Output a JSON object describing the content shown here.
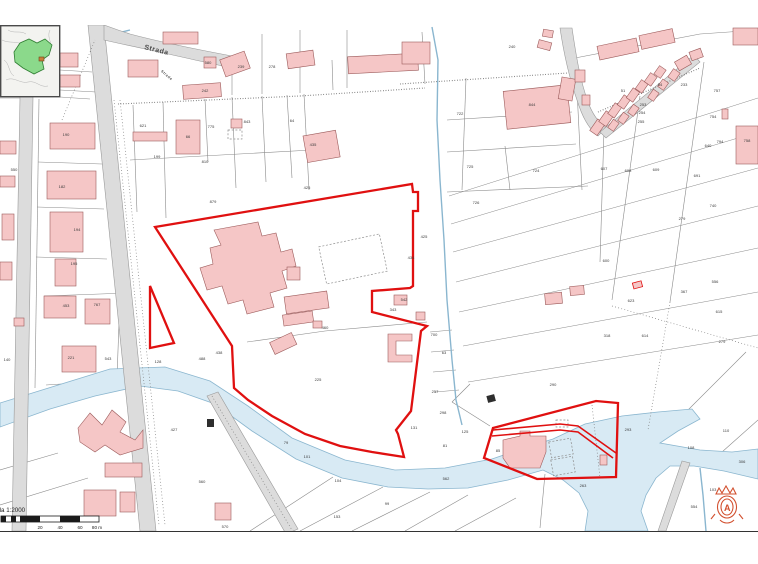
{
  "colors": {
    "boundary_red": "#e01010",
    "building_fill": "#f5c6c6",
    "building_stroke": "#9c5b5b",
    "water_fill": "#d8eaf4",
    "water_stroke": "#8ab6cf",
    "road_fill": "#dcdcdc",
    "road_stroke": "#9a9a9a",
    "parcel_line": "#8a8a8a",
    "label_color": "#3a3a3a",
    "inset_green": "#8bd98b",
    "stamp_color": "#d2502f"
  },
  "scale": {
    "text": "Scala 1:2000",
    "ticks": [
      {
        "t": "20",
        "x": 40
      },
      {
        "t": "40",
        "x": 60
      },
      {
        "t": "60",
        "x": 80
      },
      {
        "t": "80 m",
        "x": 97
      }
    ]
  },
  "road_labels": [
    {
      "t": "Strada",
      "x": 156,
      "y": 52,
      "r": 14,
      "s": 7
    },
    {
      "t": "Strada",
      "x": 166,
      "y": 76,
      "r": 40,
      "s": 3.5
    }
  ],
  "stamp": {
    "letter": "A"
  },
  "parcel_labels": [
    {
      "t": "879",
      "x": 213,
      "y": 203
    },
    {
      "t": "425",
      "x": 307,
      "y": 189
    },
    {
      "t": "425",
      "x": 424,
      "y": 238
    },
    {
      "t": "434",
      "x": 411,
      "y": 259
    },
    {
      "t": "542",
      "x": 404,
      "y": 301
    },
    {
      "t": "343",
      "x": 393,
      "y": 311
    },
    {
      "t": "700",
      "x": 434,
      "y": 336
    },
    {
      "t": "225",
      "x": 318,
      "y": 381
    },
    {
      "t": "460",
      "x": 325,
      "y": 329
    },
    {
      "t": "131",
      "x": 414,
      "y": 429
    },
    {
      "t": "257",
      "x": 435,
      "y": 393
    },
    {
      "t": "298",
      "x": 443,
      "y": 414
    },
    {
      "t": "63",
      "x": 444,
      "y": 354
    },
    {
      "t": "81",
      "x": 445,
      "y": 447
    },
    {
      "t": "79",
      "x": 286,
      "y": 444
    },
    {
      "t": "101",
      "x": 307,
      "y": 458
    },
    {
      "t": "104",
      "x": 338,
      "y": 482
    },
    {
      "t": "99",
      "x": 387,
      "y": 505
    },
    {
      "t": "153",
      "x": 337,
      "y": 518
    },
    {
      "t": "570",
      "x": 225,
      "y": 528
    },
    {
      "t": "560",
      "x": 202,
      "y": 483
    },
    {
      "t": "427",
      "x": 174,
      "y": 431
    },
    {
      "t": "128",
      "x": 158,
      "y": 363
    },
    {
      "t": "438",
      "x": 219,
      "y": 354
    },
    {
      "t": "488",
      "x": 202,
      "y": 360
    },
    {
      "t": "453",
      "x": 66,
      "y": 307
    },
    {
      "t": "767",
      "x": 97,
      "y": 306
    },
    {
      "t": "221",
      "x": 71,
      "y": 359
    },
    {
      "t": "543",
      "x": 108,
      "y": 360
    },
    {
      "t": "140",
      "x": 7,
      "y": 361
    },
    {
      "t": "190",
      "x": 66,
      "y": 136
    },
    {
      "t": "182",
      "x": 62,
      "y": 188
    },
    {
      "t": "194",
      "x": 77,
      "y": 231
    },
    {
      "t": "195",
      "x": 74,
      "y": 265
    },
    {
      "t": "550",
      "x": 14,
      "y": 171
    },
    {
      "t": "621",
      "x": 143,
      "y": 127
    },
    {
      "t": "199",
      "x": 157,
      "y": 158
    },
    {
      "t": "66",
      "x": 188,
      "y": 138
    },
    {
      "t": "775",
      "x": 211,
      "y": 128
    },
    {
      "t": "843",
      "x": 247,
      "y": 123
    },
    {
      "t": "64",
      "x": 292,
      "y": 122
    },
    {
      "t": "435",
      "x": 313,
      "y": 146
    },
    {
      "t": "242",
      "x": 205,
      "y": 92
    },
    {
      "t": "580",
      "x": 208,
      "y": 64
    },
    {
      "t": "239",
      "x": 241,
      "y": 68
    },
    {
      "t": "278",
      "x": 272,
      "y": 68
    },
    {
      "t": "810",
      "x": 205,
      "y": 163
    },
    {
      "t": "844",
      "x": 532,
      "y": 106
    },
    {
      "t": "240",
      "x": 512,
      "y": 48
    },
    {
      "t": "722",
      "x": 460,
      "y": 115
    },
    {
      "t": "724",
      "x": 536,
      "y": 172
    },
    {
      "t": "725",
      "x": 470,
      "y": 168
    },
    {
      "t": "726",
      "x": 476,
      "y": 204
    },
    {
      "t": "757",
      "x": 717,
      "y": 92
    },
    {
      "t": "754",
      "x": 713,
      "y": 118
    },
    {
      "t": "794",
      "x": 720,
      "y": 143
    },
    {
      "t": "640",
      "x": 708,
      "y": 147
    },
    {
      "t": "691",
      "x": 697,
      "y": 177
    },
    {
      "t": "740",
      "x": 713,
      "y": 207
    },
    {
      "t": "279",
      "x": 682,
      "y": 220
    },
    {
      "t": "600",
      "x": 606,
      "y": 262
    },
    {
      "t": "556",
      "x": 715,
      "y": 283
    },
    {
      "t": "367",
      "x": 684,
      "y": 293
    },
    {
      "t": "623",
      "x": 631,
      "y": 302
    },
    {
      "t": "615",
      "x": 719,
      "y": 313
    },
    {
      "t": "614",
      "x": 645,
      "y": 337
    },
    {
      "t": "318",
      "x": 607,
      "y": 337
    },
    {
      "t": "279",
      "x": 722,
      "y": 343
    },
    {
      "t": "607",
      "x": 604,
      "y": 170
    },
    {
      "t": "608",
      "x": 628,
      "y": 172
    },
    {
      "t": "609",
      "x": 656,
      "y": 171
    },
    {
      "t": "54",
      "x": 660,
      "y": 86
    },
    {
      "t": "233",
      "x": 684,
      "y": 86
    },
    {
      "t": "51",
      "x": 623,
      "y": 92
    },
    {
      "t": "253",
      "x": 643,
      "y": 106
    },
    {
      "t": "254",
      "x": 642,
      "y": 114
    },
    {
      "t": "255",
      "x": 641,
      "y": 123
    },
    {
      "t": "85",
      "x": 498,
      "y": 452
    },
    {
      "t": "290",
      "x": 553,
      "y": 386
    },
    {
      "t": "125",
      "x": 465,
      "y": 433
    },
    {
      "t": "562",
      "x": 446,
      "y": 480
    },
    {
      "t": "293",
      "x": 628,
      "y": 431
    },
    {
      "t": "263",
      "x": 583,
      "y": 487
    },
    {
      "t": "110",
      "x": 726,
      "y": 432
    },
    {
      "t": "108",
      "x": 691,
      "y": 449
    },
    {
      "t": "103",
      "x": 713,
      "y": 491
    },
    {
      "t": "554",
      "x": 694,
      "y": 508
    },
    {
      "t": "306",
      "x": 742,
      "y": 463
    },
    {
      "t": "758",
      "x": 747,
      "y": 142
    }
  ]
}
